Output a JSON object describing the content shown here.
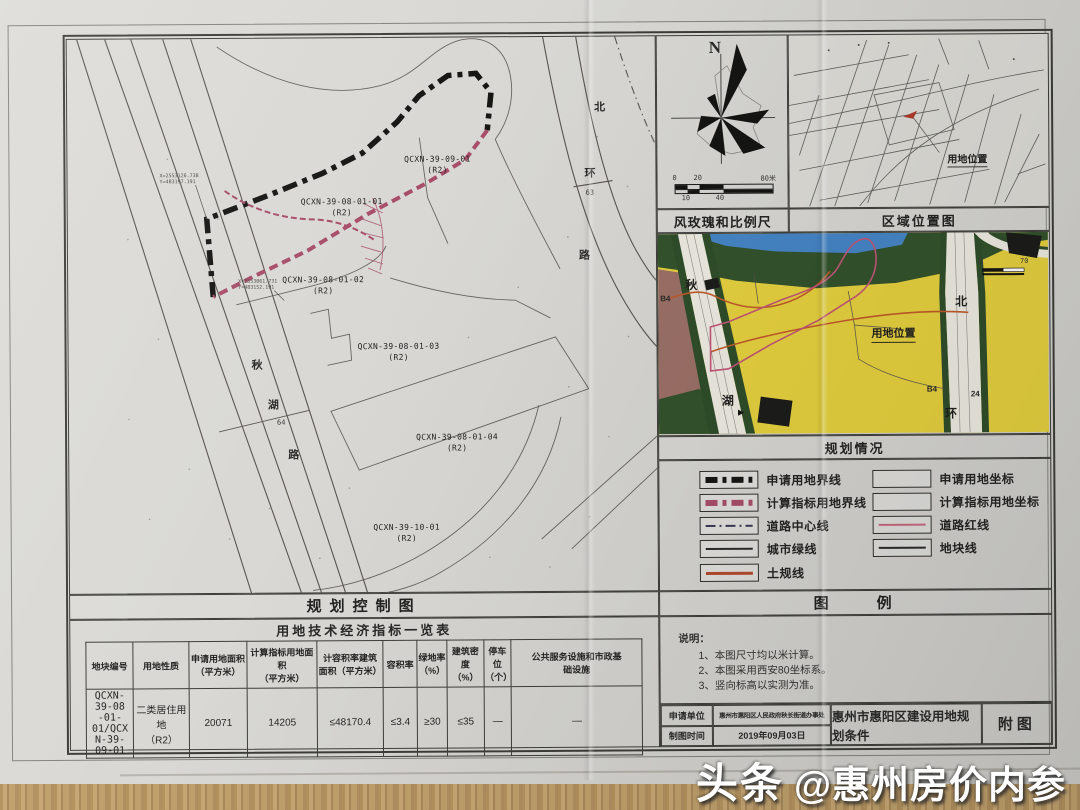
{
  "watermark": {
    "brand": "头条",
    "account": "@惠州房价内参"
  },
  "colors": {
    "apply_boundary_black": "#1a1a1a",
    "indicator_boundary_pink": "#b5536f",
    "road_redline_pink": "#c46a80",
    "tugui_line_red": "#b24a2e",
    "zone_yellow": "#e4cf3e",
    "zone_green": "#33522c",
    "zone_blue": "#4584c4",
    "zone_mauve": "#9a6f66"
  },
  "main_map": {
    "title": "规划控制图",
    "parcels": [
      {
        "id": "QCXN-39-09-01",
        "zone": "(R2)"
      },
      {
        "id": "QCXN-39-08-01-01",
        "zone": "(R2)"
      },
      {
        "id": "QCXN-39-08-01-02",
        "zone": "(R2)"
      },
      {
        "id": "QCXN-39-08-01-03",
        "zone": "(R2)"
      },
      {
        "id": "QCXN-39-08-01-04",
        "zone": "(R2)"
      },
      {
        "id": "QCXN-39-10-01",
        "zone": "(R2)"
      }
    ],
    "west_road": {
      "char1": "秋",
      "char2": "湖",
      "width": "64",
      "char3": "路"
    },
    "east_road": {
      "char1": "北",
      "char2": "环",
      "width": "63",
      "char3": "路"
    },
    "coord_note_1": {
      "line1": "X=2553126.738",
      "line2": "Y=483197.191"
    },
    "coord_note_2": {
      "line1": "X=2553061.731",
      "line2": "Y=483152.191"
    }
  },
  "wind_panel": {
    "title": "风玫瑰和比例尺",
    "north": "N",
    "scale": {
      "t0": "0",
      "t20": "20",
      "t80": "80米",
      "b10": "10",
      "b40": "40"
    }
  },
  "region_panel": {
    "title": "区域位置图",
    "site_label": "用地位置"
  },
  "plan_panel": {
    "title": "规划情况",
    "site_label": "用地位置",
    "west_top": "秋",
    "west_bottom": "湖",
    "east_top": "北",
    "east_bottom": "环",
    "b4_left": "B4",
    "b4_right": "B4",
    "b4_right2": "24",
    "scale_left": "0",
    "scale_right": "70",
    "arrow": "▶"
  },
  "legend": {
    "title": "图　　例",
    "left": [
      {
        "label": "申请用地界线"
      },
      {
        "label": "计算指标用地界线"
      },
      {
        "label": "道路中心线"
      },
      {
        "label": "城市绿线"
      },
      {
        "label": "土规线"
      }
    ],
    "right": [
      {
        "label": "申请用地坐标"
      },
      {
        "label": "计算指标用地坐标"
      },
      {
        "label": "道路红线"
      },
      {
        "label": "地块线"
      }
    ]
  },
  "notes": {
    "heading": "说明：",
    "items": [
      "1、本图尺寸均以米计算。",
      "2、本图采用西安80坐标系。",
      "3、竖向标高以实测为准。"
    ]
  },
  "info_table": {
    "rows": [
      {
        "label": "申请单位",
        "value": "惠州市惠阳区人民政府秋长街道办事处"
      },
      {
        "label": "制图时间",
        "value": "2019年09月03日"
      }
    ],
    "doc_title": "惠州市惠阳区建设用地规划条件",
    "attachment": "附图"
  },
  "econ_table": {
    "title": "用地技术经济指标一览表",
    "headers": [
      "地块编号",
      "用地性质",
      "申请用地面积\n（平方米）",
      "计算指标用地面积\n（平方米）",
      "计容积率建筑\n面积（平方米）",
      "容积率",
      "绿地率\n（%）",
      "建筑密度\n（%）",
      "停车位\n（个）",
      "公共服务设施和市政基\n础设施"
    ],
    "row": [
      "QCXN-39-08\n-01-01/QCX\nN-39-09-01",
      "二类居住用地\n（R2）",
      "20071",
      "14205",
      "≤48170.4",
      "≤3.4",
      "≥30",
      "≤35",
      "—",
      "—"
    ]
  }
}
